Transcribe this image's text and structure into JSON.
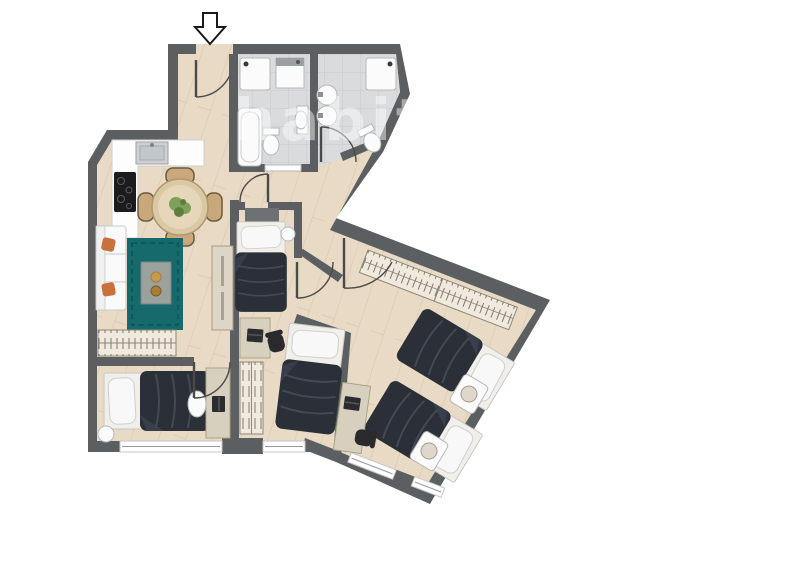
{
  "scene": {
    "kind": "apartment-floor-plan",
    "canvas": {
      "width": 800,
      "height": 565
    },
    "orientation": "entrance-top, angled right wing"
  },
  "watermark": {
    "text": "habitaclia",
    "opacity": "0.45"
  },
  "entrance": {
    "icon": "down-arrow",
    "door_type": "single-swing"
  },
  "colors": {
    "wall": "#5b5f62",
    "headboard": "#6d7174",
    "floor": "#e8dac4",
    "plank": "#d9c7ab",
    "tile": "#d9dbdd",
    "tile_line": "#c7c9cc",
    "fixture": "#fbfbfb",
    "fixture_stroke": "#b5b8bb",
    "steel": "#ccd0d3",
    "steel_dark": "#9fa4a8",
    "cooktop": "#1c1c1e",
    "rug": "#166a6c",
    "rug_line": "#0d5254",
    "duvet": "#2a2f38",
    "duvet_fold": "#424a56",
    "mattress": "#f1efea",
    "pillow": "#f8f8f8",
    "pillow_stroke": "#cfcfcf",
    "sofa": "#fafafa",
    "sofa_stroke": "#c9c9c9",
    "cushion": "#c8713d",
    "wood_table": "#dbc8a5",
    "wood_table_stroke": "#b1976e",
    "chair_wood": "#c9a87c",
    "chair_wood_stroke": "#6b5b41",
    "desk": "#d8d0bf",
    "desk_stroke": "#ada386",
    "cabinet": "#ddd5c5",
    "cabinet_stroke": "#a69c88",
    "wardrobe": "#efe9de",
    "wardrobe_stroke": "#8f8878",
    "tick": "#6e6759",
    "chair_black": "#2a2a2c",
    "table_gray": "#9ba19d",
    "table_gray_stroke": "#7d827f",
    "decor_gold": "#c79b4e",
    "decor_gold2": "#a97f35",
    "plant": "#7fa05a",
    "plant_dark": "#5c7d3c",
    "lamp": "#ded7cb",
    "lamp_stroke": "#a59d8e",
    "door_arc": "#4a4a4a",
    "window_line": "#9a9a9a",
    "window_stroke": "#c7c7c7",
    "arrow_stroke": "#1a1a1a",
    "washer_band": "#9aa0a4"
  },
  "rooms": [
    {
      "id": "entry-hall",
      "floor": "wood",
      "furniture": [
        "entrance-door"
      ]
    },
    {
      "id": "bathroom-1",
      "floor": "tile",
      "furniture": [
        "shower",
        "washing-machine",
        "bathtub",
        "toilet",
        "washbasin",
        "sliding-door"
      ]
    },
    {
      "id": "bathroom-2",
      "floor": "tile",
      "furniture": [
        "shower",
        "double-washbasin",
        "toilet",
        "swing-door"
      ]
    },
    {
      "id": "kitchen",
      "floor": "wood",
      "furniture": [
        "l-shaped-counter",
        "sink",
        "cooktop"
      ]
    },
    {
      "id": "dining-area",
      "floor": "wood",
      "furniture": [
        "round-table",
        "four-chairs",
        "plant-centerpiece"
      ]
    },
    {
      "id": "living-area",
      "floor": "wood",
      "furniture": [
        "sofa",
        "two-orange-cushions",
        "teal-rug",
        "coffee-table",
        "sideboard",
        "tall-cabinet"
      ]
    },
    {
      "id": "bedroom-1",
      "floor": "wood",
      "furniture": [
        "single-bed",
        "headboard",
        "round-side-table",
        "desk",
        "laptop",
        "office-chair",
        "wardrobe"
      ]
    },
    {
      "id": "bedroom-2",
      "floor": "wood",
      "furniture": [
        "single-bed",
        "window"
      ]
    },
    {
      "id": "bedroom-3",
      "floor": "wood",
      "furniture": [
        "single-bed",
        "single-bed",
        "nightstand",
        "nightstand",
        "lamp",
        "lamp",
        "long-wardrobe",
        "desk",
        "laptop",
        "office-chair",
        "windows"
      ]
    },
    {
      "id": "bedroom-4",
      "floor": "wood",
      "furniture": [
        "single-bed",
        "round-bedside",
        "desk",
        "laptop",
        "chair",
        "window"
      ]
    }
  ]
}
